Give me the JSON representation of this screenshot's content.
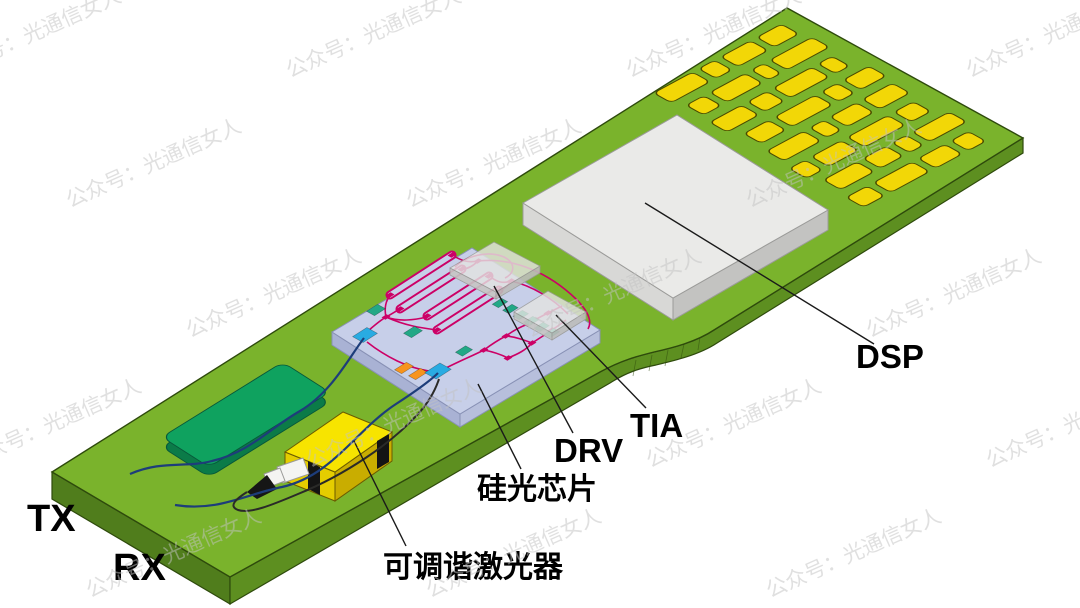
{
  "labels": {
    "tx": "TX",
    "rx": "RX",
    "tunable_laser": "可调谐激光器",
    "silicon_photonics_chip": "硅光芯片",
    "driver": "DRV",
    "tia": "TIA",
    "dsp": "DSP"
  },
  "watermark": {
    "text": "公众号：光通信女人",
    "color": "#c3c3c3",
    "opacity": 0.5,
    "angle": -24,
    "font_size": 21
  },
  "colors": {
    "background": "#ffffff",
    "pcb_top": "#7ab32c",
    "pcb_front": "#5d8f20",
    "pcb_end": "#507d1c",
    "pcb_outline": "#2e4a0c",
    "gold_pad": "#f2d707",
    "gold_pad_outline": "#4a4a00",
    "dsp_top": "#eaeae8",
    "dsp_side_left": "#d8d8d6",
    "dsp_side_right": "#c3c3c1",
    "dsp_outline": "#9b9b99",
    "chip_top": "#c7cfe9",
    "chip_side_left": "#a9b2d4",
    "chip_side_right": "#b7bfdc",
    "chip_outline": "#8891b5",
    "waveguide": "#cc0066",
    "coupler_cyan": "#29abe2",
    "pad_teal": "#22a886",
    "pad_orange": "#f7941d",
    "gray_die_top": "#e3e3e1",
    "gray_die_side": "#c6c6c4",
    "submount_top": "#0fa25f",
    "submount_side": "#0b7b48",
    "laser_top": "#f7e400",
    "laser_side_left": "#e5cd00",
    "laser_side_right": "#c9ad00",
    "laser_outline": "#6b5b00",
    "strap_black": "#141414",
    "ferrule_white": "#f4f4f2",
    "ferrule_tip": "#161616",
    "fiber_blue": "#1d3d7a",
    "fiber_dark": "#2a2a28",
    "leader": "#1a1a1a",
    "label_text": "#000000"
  },
  "gold_pads": {
    "rows": [
      [
        44,
        18,
        34,
        28
      ],
      [
        20,
        40,
        14,
        48
      ],
      [
        36,
        22,
        44,
        16
      ],
      [
        28,
        46,
        18,
        30
      ],
      [
        42,
        16,
        30,
        34
      ],
      [
        18,
        34,
        46,
        22
      ],
      [
        38,
        26,
        16,
        42
      ],
      [
        24,
        44,
        30,
        20
      ]
    ],
    "offsets": [
      0,
      6,
      2,
      10,
      5,
      0,
      8,
      3
    ],
    "gap": 7,
    "row_pitch": 31,
    "pad_height": 20
  }
}
